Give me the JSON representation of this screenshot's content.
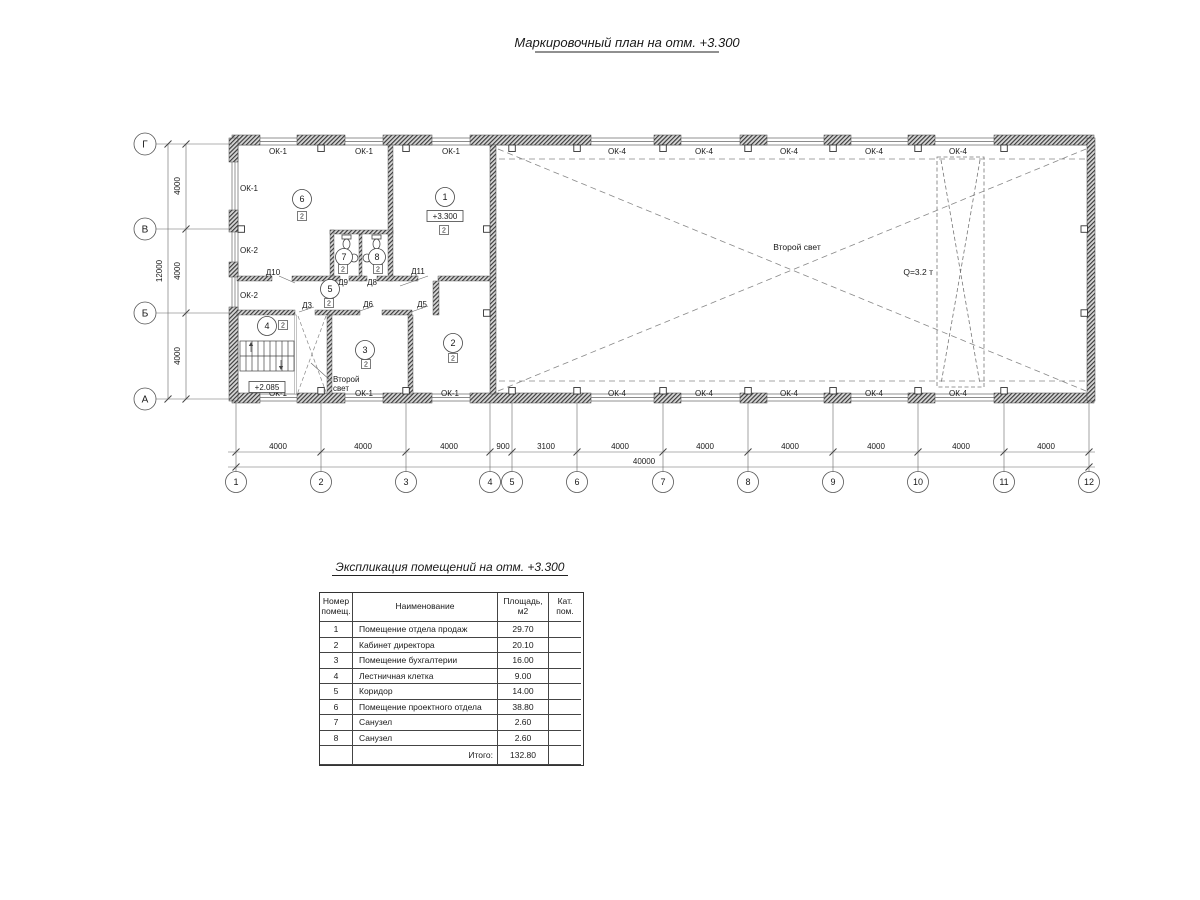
{
  "title": "Маркировочный план на отм. +3.300",
  "plan": {
    "axes_h": [
      "1",
      "2",
      "3",
      "4",
      "5",
      "6",
      "7",
      "8",
      "9",
      "10",
      "11",
      "12"
    ],
    "axes_v": [
      "Г",
      "В",
      "Б",
      "А"
    ],
    "dims_h": [
      "4000",
      "4000",
      "4000",
      "900",
      "3100",
      "4000",
      "4000",
      "4000",
      "4000",
      "4000",
      "4000"
    ],
    "total_h": "40000",
    "dims_v": [
      "4000",
      "4000",
      "4000"
    ],
    "total_v": "12000",
    "ok1_top": [
      "ОК-1",
      "ОК-1",
      "ОК-1"
    ],
    "ok1_left": "ОК-1",
    "ok2_left": [
      "ОК-2",
      "ОК-2"
    ],
    "ok1_bottom": [
      "ОК-1",
      "ОК-1",
      "ОК-1"
    ],
    "ok4_top": [
      "ОК-4",
      "ОК-4",
      "ОК-4",
      "ОК-4",
      "ОК-4"
    ],
    "ok4_bottom": [
      "ОК-4",
      "ОК-4",
      "ОК-4",
      "ОК-4",
      "ОК-4"
    ],
    "doors": {
      "d10": "Д10",
      "d9": "Д9",
      "d8": "Д8",
      "d11": "Д11",
      "d3": "Д3",
      "d6": "Д6",
      "d5": "Д5"
    },
    "rooms": [
      "1",
      "2",
      "3",
      "4",
      "5",
      "6",
      "7",
      "8"
    ],
    "badge": "2",
    "elev_main": "+3.300",
    "elev_stair": "+2.085",
    "second_light_hall": "Второй свет",
    "second_light_office_1": "Второй",
    "second_light_office_2": "свет",
    "crane": "Q=3.2 т"
  },
  "table": {
    "title": "Экспликация помещений на отм. +3.300",
    "headers": [
      "Номер\nпомещ.",
      "Наименование",
      "Площадь,\nм2",
      "Кат.\nпом."
    ],
    "rows": [
      {
        "num": "1",
        "name": "Помещение отдела продаж",
        "area": "29.70",
        "cat": ""
      },
      {
        "num": "2",
        "name": "Кабинет директора",
        "area": "20.10",
        "cat": ""
      },
      {
        "num": "3",
        "name": "Помещение бухгалтерии",
        "area": "16.00",
        "cat": ""
      },
      {
        "num": "4",
        "name": "Лестничная клетка",
        "area": "9.00",
        "cat": ""
      },
      {
        "num": "5",
        "name": "Коридор",
        "area": "14.00",
        "cat": ""
      },
      {
        "num": "6",
        "name": "Помещение проектного отдела",
        "area": "38.80",
        "cat": ""
      },
      {
        "num": "7",
        "name": "Санузел",
        "area": "2.60",
        "cat": ""
      },
      {
        "num": "8",
        "name": "Санузел",
        "area": "2.60",
        "cat": ""
      }
    ],
    "total_label": "Итого:",
    "total_value": "132.80"
  }
}
